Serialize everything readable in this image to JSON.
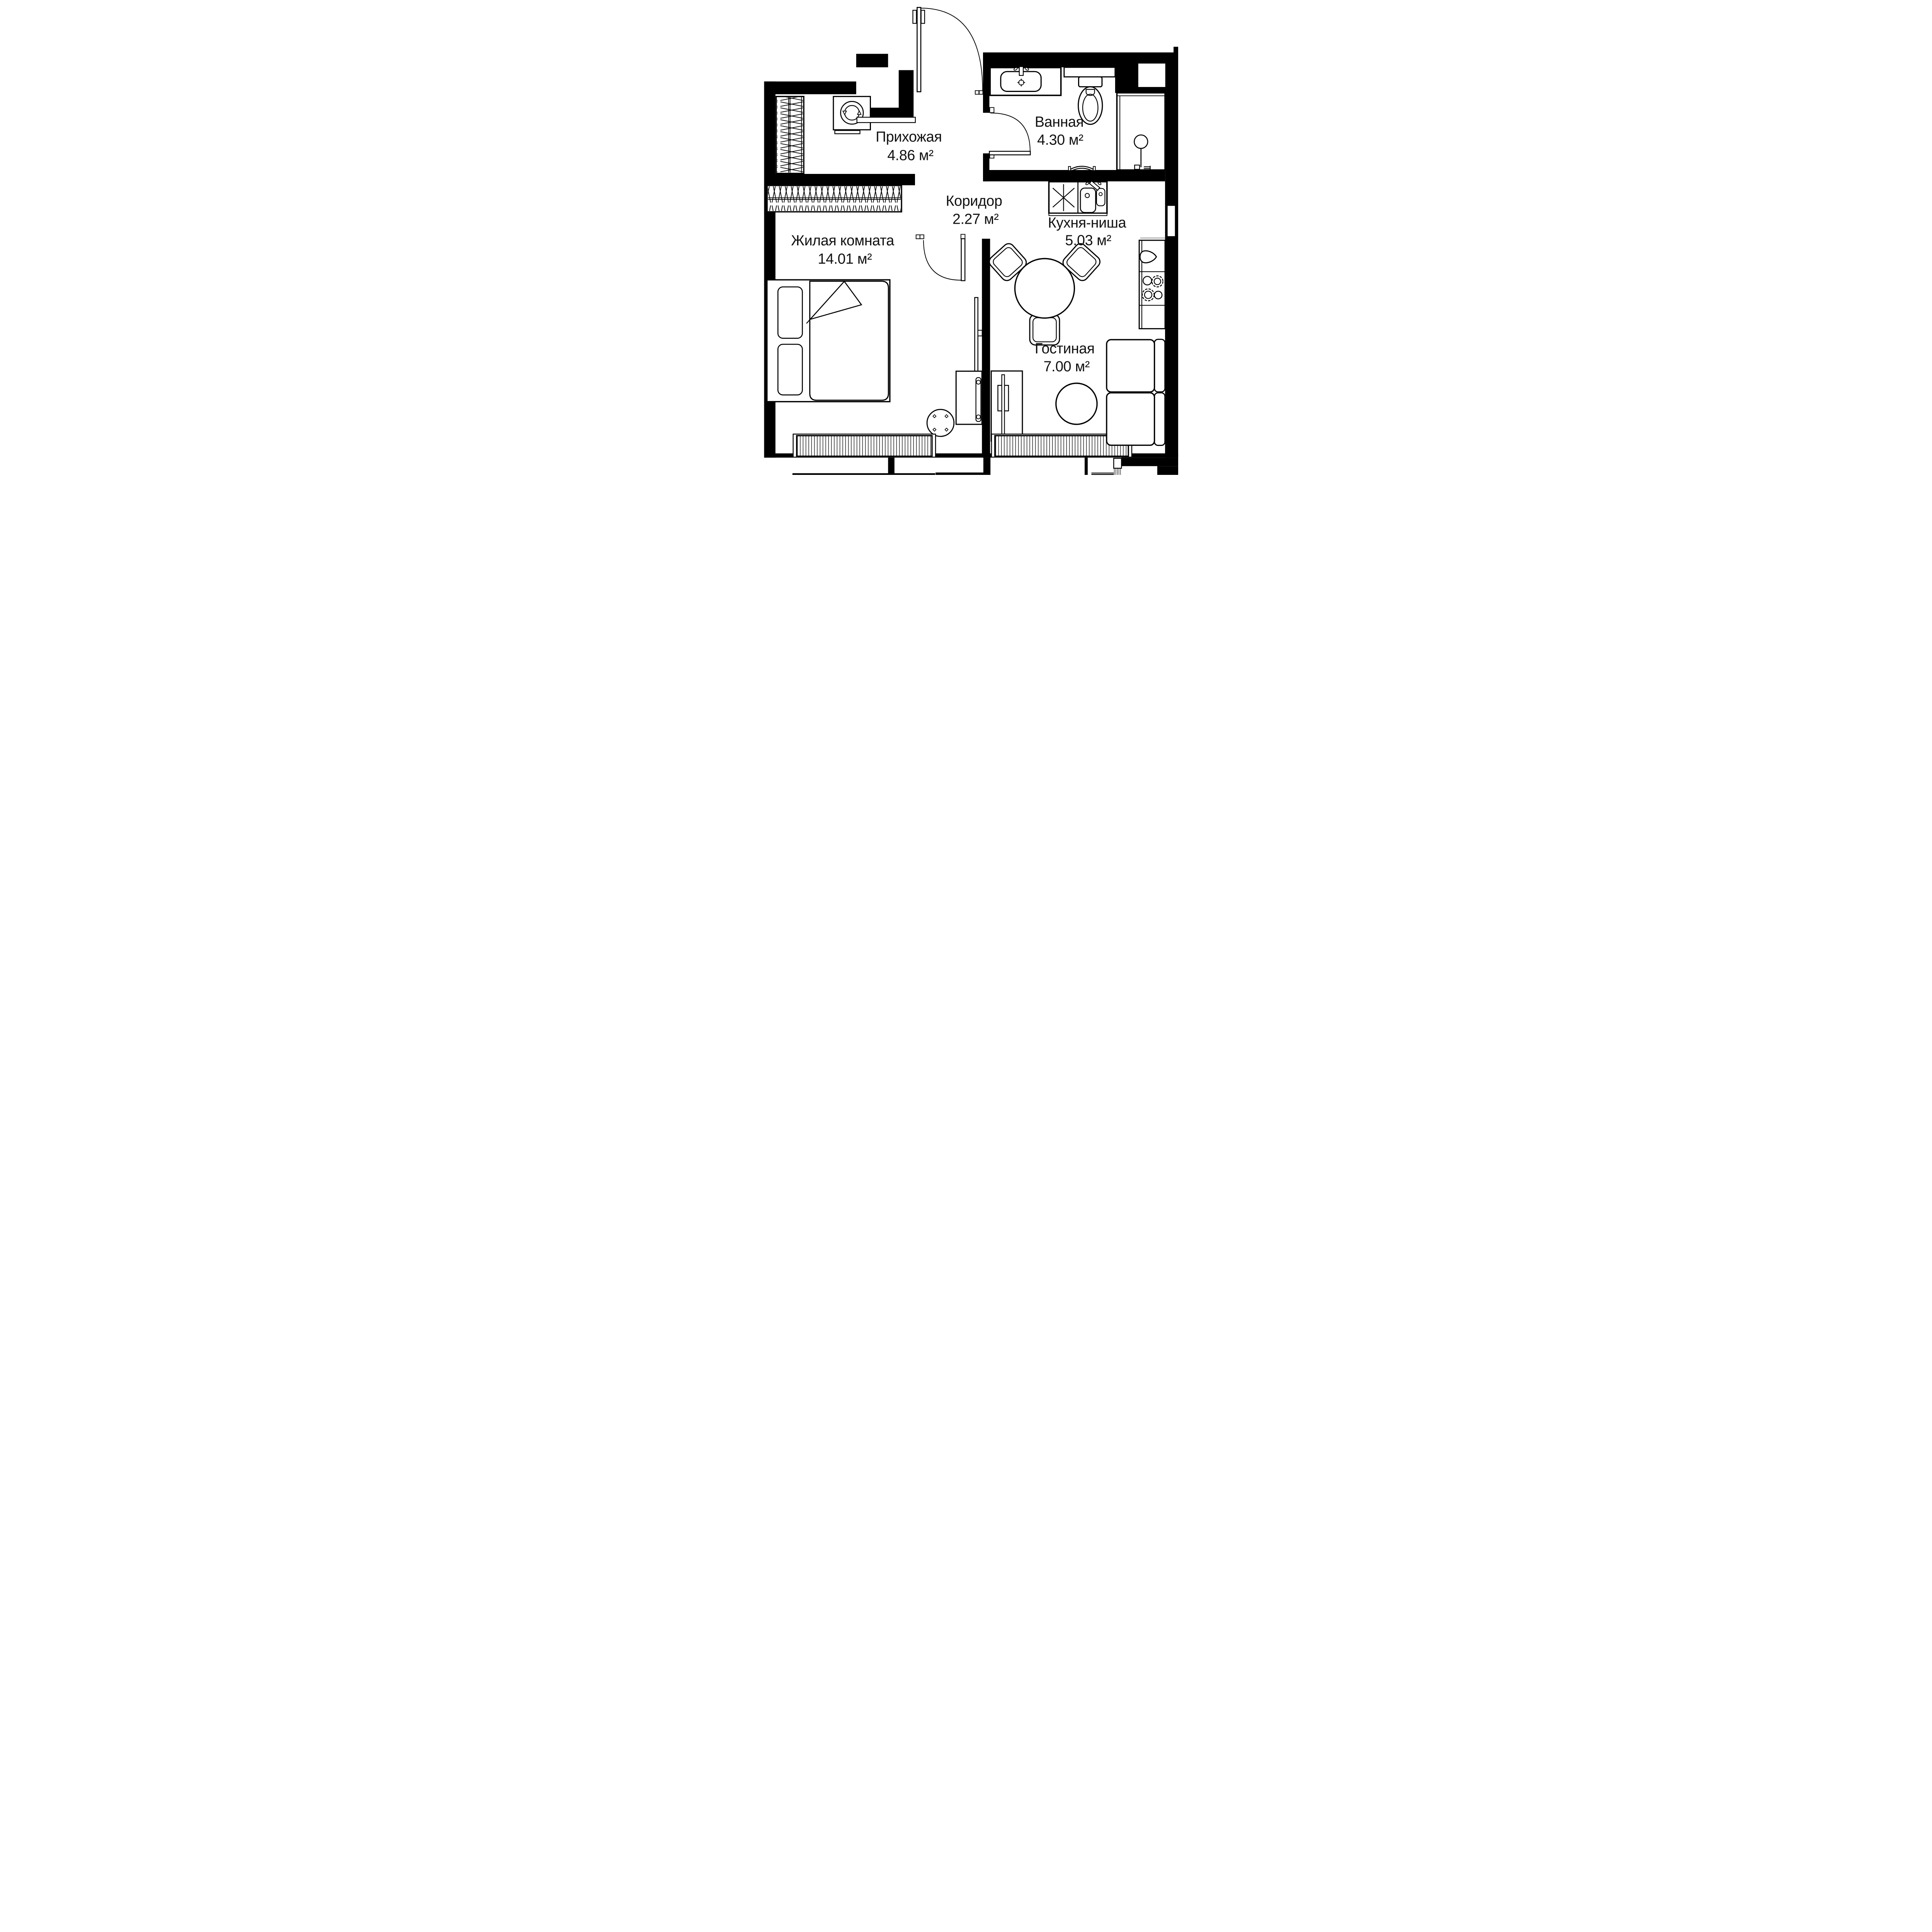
{
  "plan_title": "1-room apartment floor plan",
  "rooms": [
    {
      "name": "Прихожая",
      "area": "4.86 м²"
    },
    {
      "name": "Ванная",
      "area": "4.30 м²"
    },
    {
      "name": "Коридор",
      "area": "2.27 м²"
    },
    {
      "name": "Кухня-ниша",
      "area": "5.03 м²"
    },
    {
      "name": "Жилая комната",
      "area": "14.01 м²"
    },
    {
      "name": "Гостиная",
      "area": "7.00 м²"
    }
  ],
  "colors": {
    "walls": "#000000",
    "lines": "#1a1a1a",
    "window_glass": "#b3b3b3",
    "background": "#ffffff"
  },
  "symbols": [
    "entry-door-arc",
    "bathroom-door-arc",
    "room-door-arc",
    "wardrobe-hangers",
    "washing-machine",
    "bath-sink",
    "toilet",
    "shower-cabin",
    "towel-rail",
    "fridge-cross",
    "kitchen-sink",
    "teardrop-board",
    "stove-burners",
    "dining-table-3-chairs",
    "double-bed",
    "tv-panel",
    "dresser",
    "round-side-table",
    "coffee-table",
    "sofa",
    "radiator-fins",
    "window-niche"
  ]
}
